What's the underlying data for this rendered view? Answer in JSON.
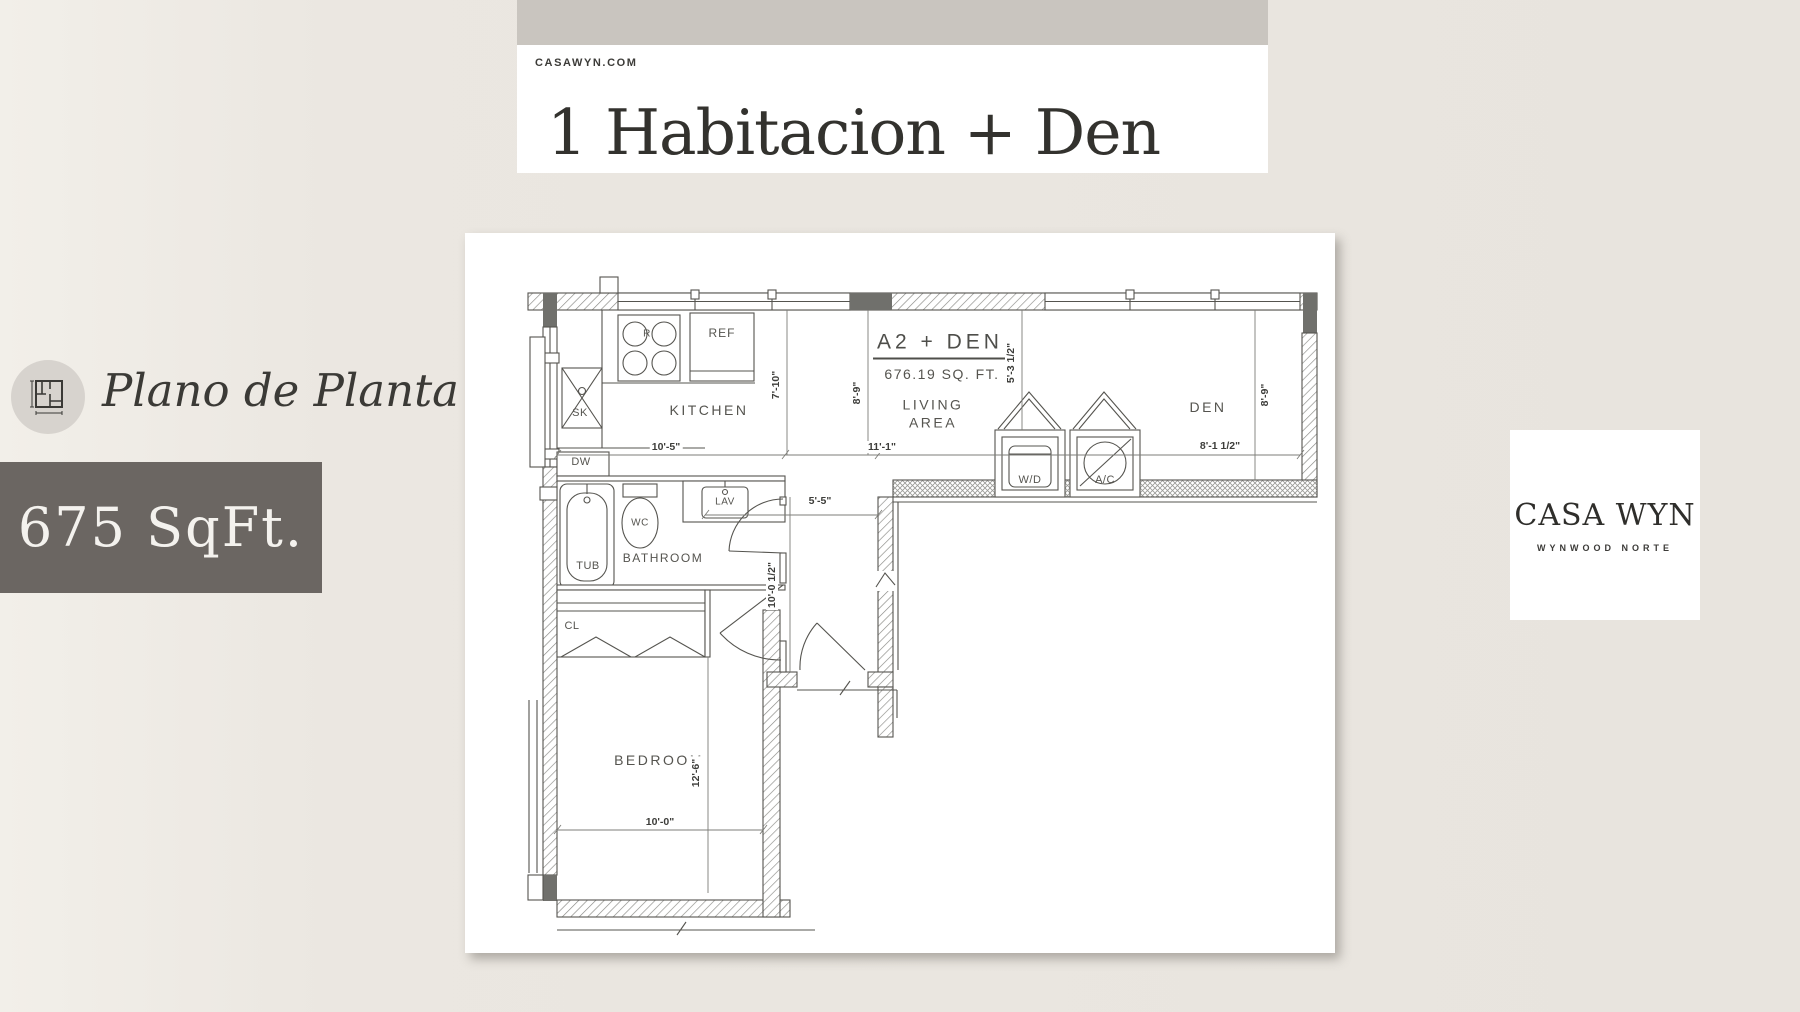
{
  "header": {
    "site": "CASAWYN.COM",
    "title": "1 Habitacion + Den"
  },
  "sidebar": {
    "plan_label": "Plano de Planta",
    "area_label": "675 SqFt."
  },
  "brand": {
    "name": "CASA WYN",
    "tagline": "WYNWOOD NORTE"
  },
  "floor_plan": {
    "unit_name": "A2 + DEN",
    "unit_area": "676.19 SQ. FT.",
    "rooms": {
      "kitchen": "KITCHEN",
      "living_1": "LIVING",
      "living_2": "AREA",
      "den": "DEN",
      "bathroom": "BATHROOM",
      "bedroom": "BEDROOM",
      "closet": "CL"
    },
    "fixtures": {
      "range": "R",
      "fridge": "REF",
      "sink": "SK",
      "dishwasher": "DW",
      "tub": "TUB",
      "toilet": "WC",
      "lavatory": "LAV",
      "washer_dryer": "W/D",
      "ac": "A/C"
    },
    "dimensions": {
      "kitchen_width": "10'-5\"",
      "living_width": "11'-1\"",
      "den_width": "8'-1 1/2\"",
      "entry_width": "5'-5\"",
      "kitchen_depth": "7'-10\"",
      "living_depth": "8'-9\"",
      "laundry_depth": "5'-3 1/2\"",
      "den_depth": "8'-9\"",
      "entry_depth": "10'-0 1/2\"",
      "bedroom_depth": "12'-6\"",
      "bedroom_width": "10'-0\""
    }
  },
  "colors": {
    "background": "#ebe7e1",
    "band": "#c9c5bf",
    "panel": "#ffffff",
    "badge": "#6b6662",
    "ink": "#33322e"
  }
}
